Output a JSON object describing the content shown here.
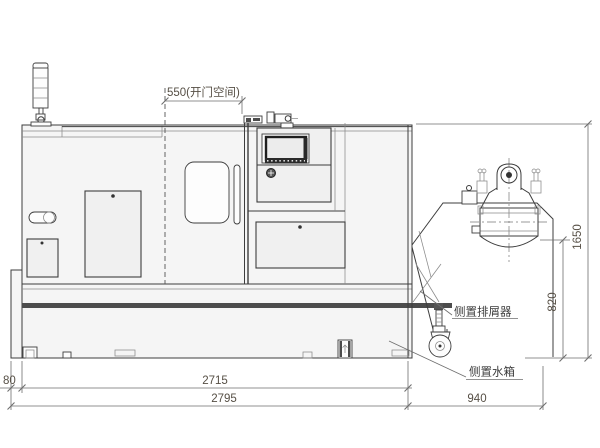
{
  "drawing": {
    "dimensions": {
      "door_opening": "550(开门空间)",
      "tank_offset": "80",
      "machine_length": "2715",
      "overall_length": "2795",
      "conveyor_extension": "940",
      "discharge_height": "820",
      "overall_height": "1650"
    },
    "labels": {
      "chip_conveyor": "侧置排屑器",
      "water_tank": "侧置水箱"
    },
    "colors": {
      "outline": "#3d3d3d",
      "thin": "#8a8a8a",
      "dim-line": "#6e6e6e",
      "dim-text": "#564f45",
      "label-text": "#3a3a3a",
      "body-fill": "#f5f5f5",
      "panel-fill": "#f0f0f0",
      "band": "#4c4c4c",
      "screen-frame": "#1e1e1e",
      "background": "#ffffff"
    }
  }
}
